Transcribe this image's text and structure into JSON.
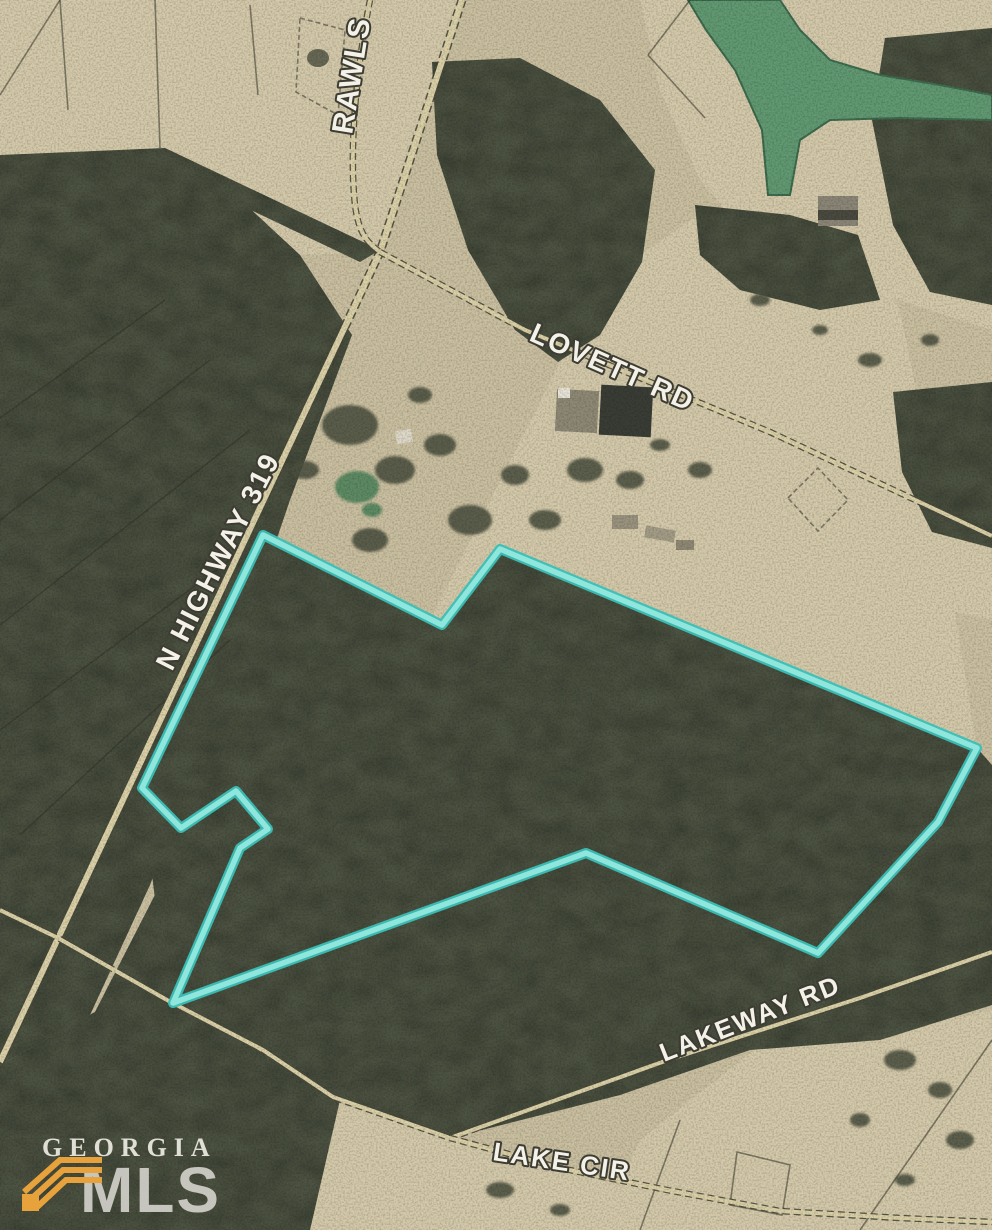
{
  "map": {
    "type": "aerial-parcel-map",
    "labels": {
      "rawls": "RAWLS",
      "highway": "N HIGHWAY 319",
      "lovett": "LOVETT RD",
      "lakeway": "LAKEWAY RD",
      "lake_cir": "LAKE CIR"
    },
    "property_boundary_points": "263,535 142,788 181,828 236,791 268,829 240,848 173,1003 586,853 818,953 938,822 977,748 500,549 442,625",
    "roads": {
      "highway_path": "M462,0 L380,252 L0,1062",
      "rawls_path": "M370,0 C356,70 349,150 355,205 C359,235 368,243 380,252",
      "lovett_path": "M380,252 L525,330 L770,432 L992,536",
      "lakeway_west_path": "M0,910 L58,938 L167,1000 L263,1050 L333,1097 L450,1138",
      "lakeway_east_path": "M450,1138 L668,1060 L860,998 L992,952",
      "lake_cir_path": "M450,1138 L560,1168 L667,1190 L780,1211 L900,1218 L992,1222"
    },
    "colors": {
      "boundary_inner": "#8fe6dc",
      "boundary_outer": "#3bbfb6",
      "field": "#cabfa0",
      "field_light": "#d4c9aa",
      "forest": "#4e5343",
      "water": "#619972",
      "road_fill": "#dbd1a8",
      "road_casing": "#4a493a",
      "label_fill": "#f4f1e8",
      "label_outline": "#3c3c33"
    }
  },
  "watermark": {
    "line1": "GEORGIA",
    "line2": "MLS",
    "icon": "stacked-roofs",
    "icon_color": "#e8a23b",
    "text_color": "#e9e6df"
  }
}
